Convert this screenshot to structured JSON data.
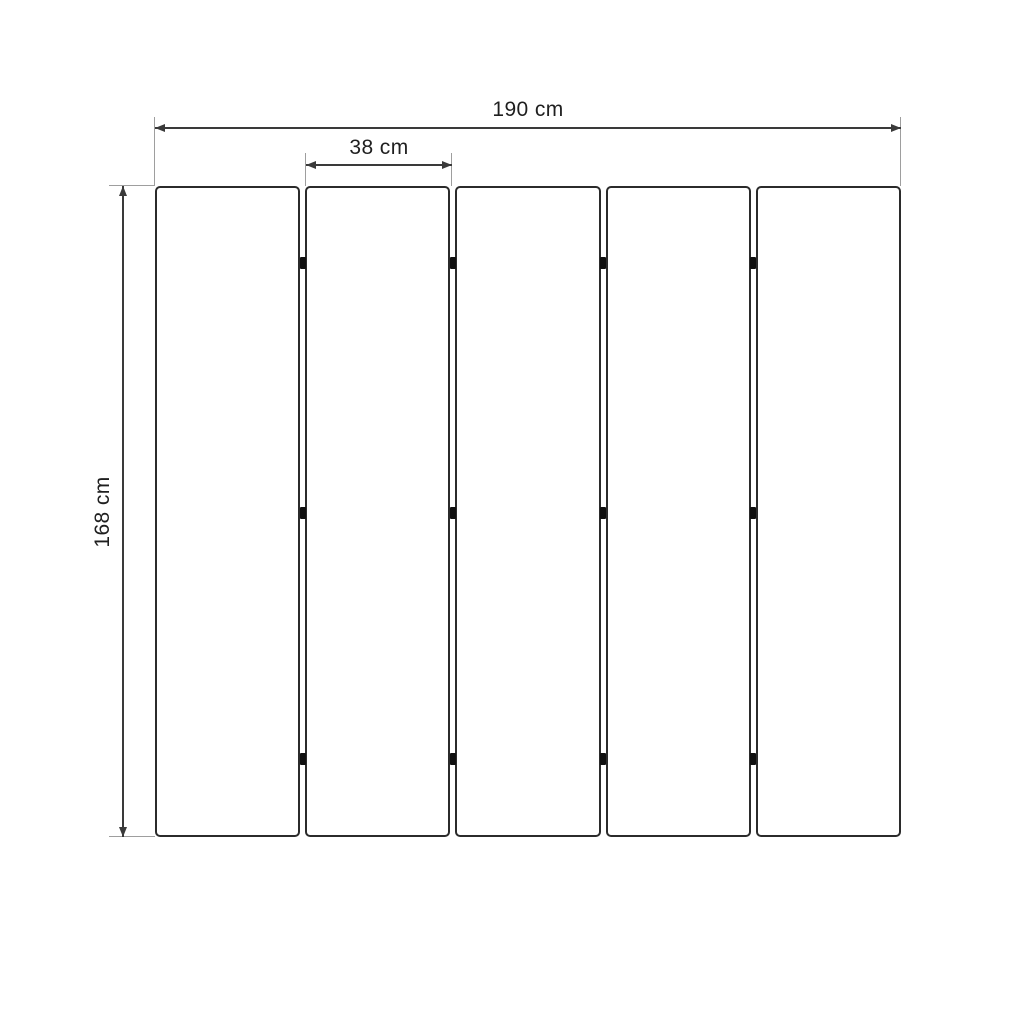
{
  "diagram": {
    "labels": {
      "total_width": "190 cm",
      "single_panel_width": "38 cm",
      "height": "168 cm"
    },
    "panels": {
      "count": 5
    },
    "hinge_marks": {
      "junctions": 4,
      "marks_per_junction": 3
    },
    "colors": {
      "background": "#ffffff",
      "dimension_line": "#3a3a3a",
      "panel_outline": "#2b2b2b",
      "extension_line": "#9e9e9e",
      "hinge": "#101010",
      "text": "#1f1f1f"
    }
  }
}
